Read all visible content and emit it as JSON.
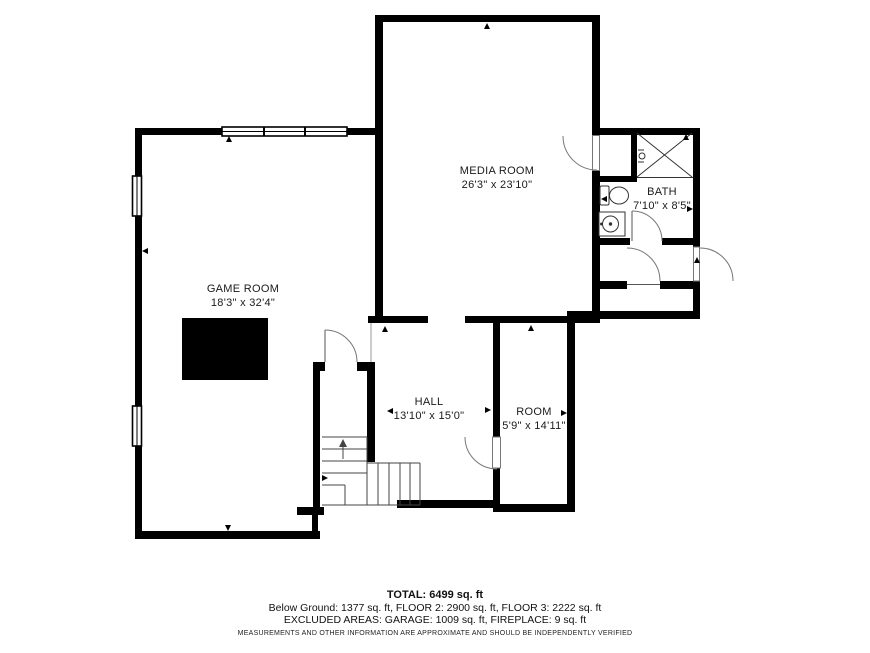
{
  "rooms": {
    "media": {
      "name": "MEDIA ROOM",
      "dims": "26'3\" x 23'10\""
    },
    "bath": {
      "name": "BATH",
      "dims": "7'10\" x 8'5\""
    },
    "game": {
      "name": "GAME ROOM",
      "dims": "18'3\" x 32'4\""
    },
    "hall": {
      "name": "HALL",
      "dims": "13'10\" x 15'0\""
    },
    "room": {
      "name": "ROOM",
      "dims": "5'9\" x 14'11\""
    }
  },
  "footer": {
    "total": "TOTAL: 6499 sq. ft",
    "floors": "Below Ground: 1377 sq. ft, FLOOR 2: 2900 sq. ft, FLOOR 3: 2222 sq. ft",
    "excluded": "EXCLUDED AREAS: GARAGE: 1009 sq. ft, FIREPLACE: 9 sq. ft",
    "disclaimer": "MEASUREMENTS AND OTHER INFORMATION ARE APPROXIMATE AND SHOULD BE INDEPENDENTLY VERIFIED"
  },
  "colors": {
    "wall": "#000000",
    "background": "#ffffff",
    "thin_line": "#555555"
  }
}
